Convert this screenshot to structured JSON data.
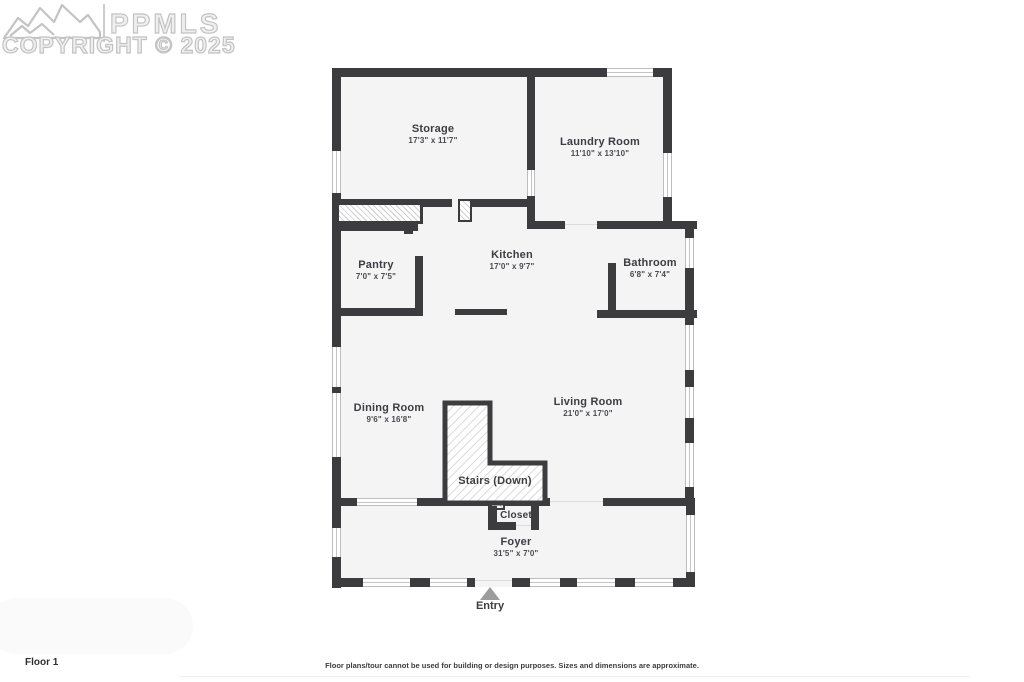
{
  "watermark": {
    "brand": "PPMLS",
    "copyright": "COPYRIGHT © 2025"
  },
  "rooms": {
    "storage": {
      "name": "Storage",
      "dims": "17'3\" x 11'7\""
    },
    "laundry": {
      "name": "Laundry Room",
      "dims": "11'10\" x 13'10\""
    },
    "pantry": {
      "name": "Pantry",
      "dims": "7'0\" x 7'5\""
    },
    "kitchen": {
      "name": "Kitchen",
      "dims": "17'0\" x 9'7\""
    },
    "bathroom": {
      "name": "Bathroom",
      "dims": "6'8\" x 7'4\""
    },
    "dining": {
      "name": "Dining Room",
      "dims": "9'6\" x 16'8\""
    },
    "living": {
      "name": "Living Room",
      "dims": "21'0\" x 17'0\""
    },
    "stairs": {
      "name": "Stairs (Down)"
    },
    "closet": {
      "name": "Closet"
    },
    "foyer": {
      "name": "Foyer",
      "dims": "31'5\" x 7'0\""
    }
  },
  "entry_label": "Entry",
  "floor_label": "Floor 1",
  "disclaimer": "Floor plans/tour cannot be used for building or design purposes. Sizes and dimensions are approximate.",
  "colors": {
    "wall": "#3c3c3e",
    "room_fill": "#f4f4f4",
    "hatch_line": "#cfcfcf",
    "watermark_gray": "#c3c3c3",
    "entry_arrow": "#9c9c9c"
  }
}
